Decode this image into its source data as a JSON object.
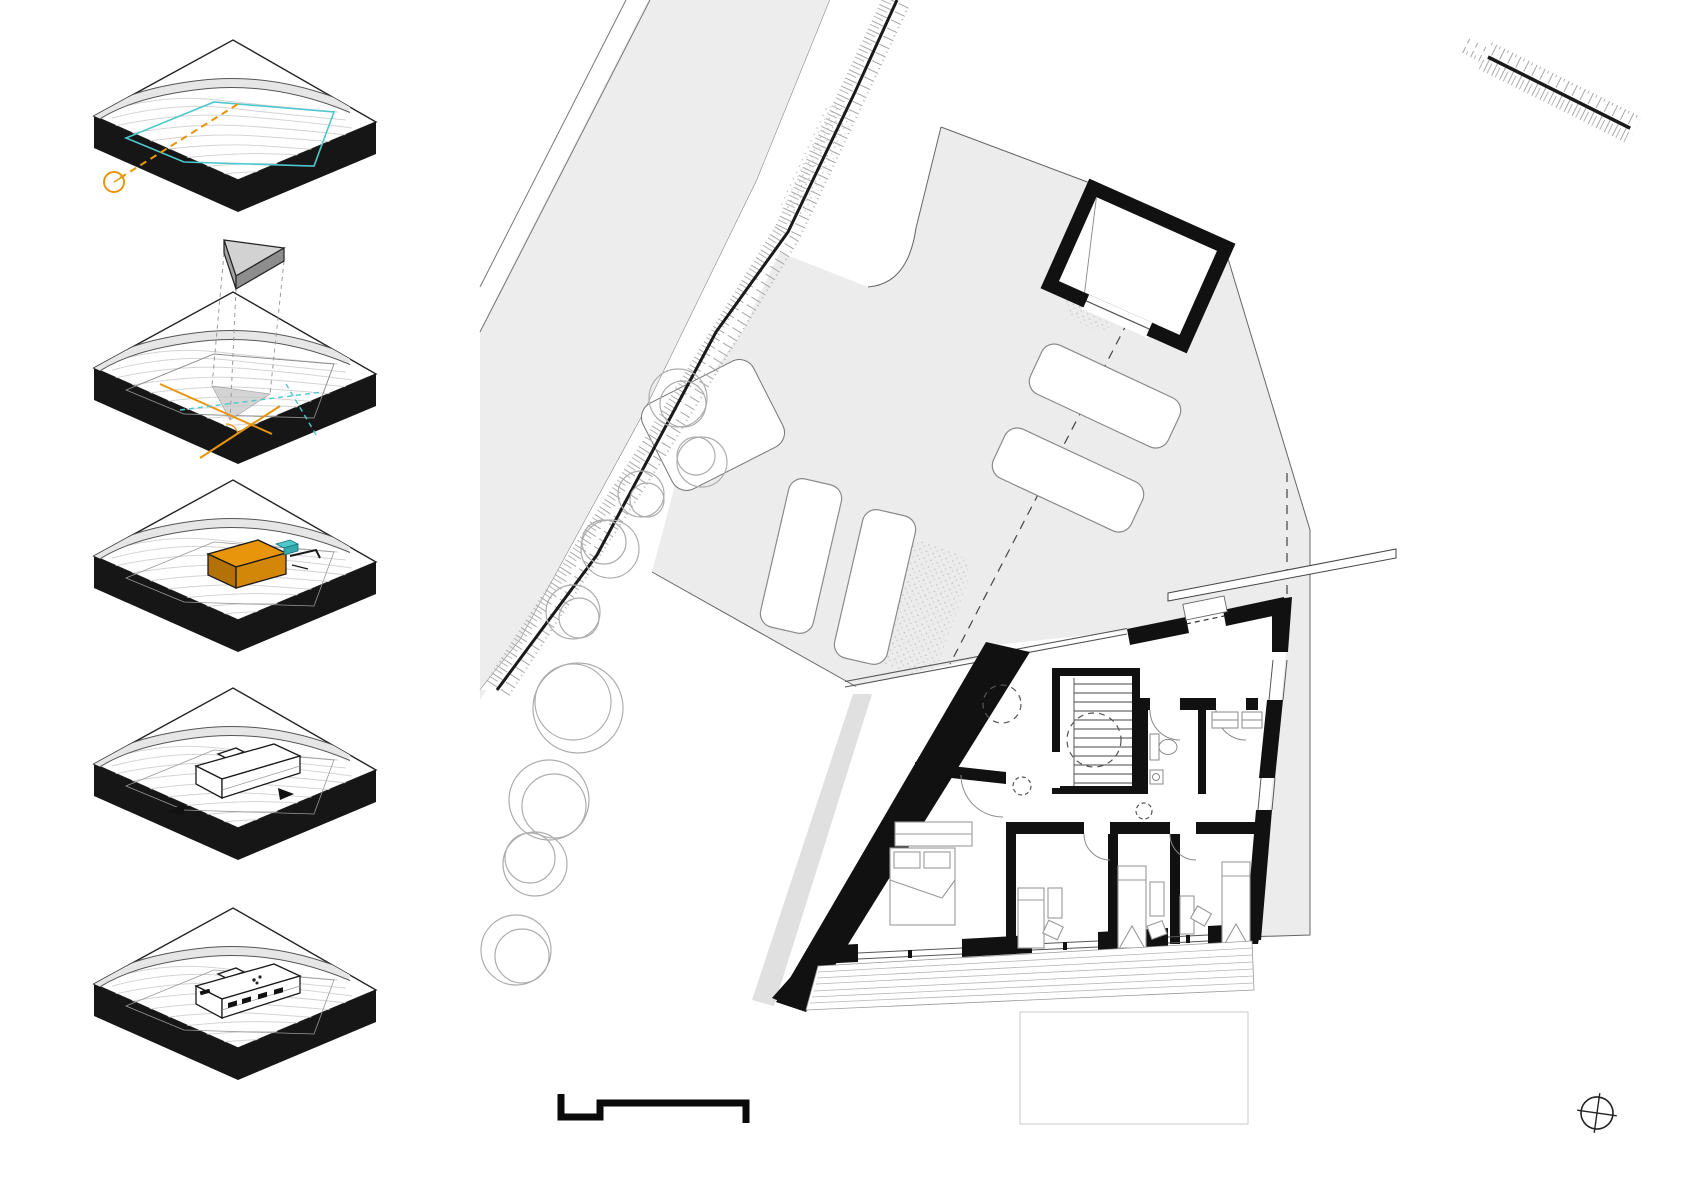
{
  "canvas": {
    "width_px": 1684,
    "height_px": 1191,
    "background": "#ffffff"
  },
  "colors": {
    "accent_orange": "#E8950B",
    "accent_orange_dark": "#B37208",
    "accent_orange_mid": "#D38708",
    "accent_cyan": "#4EC8CE",
    "ink": "#111111",
    "site_gray": "#ECECEC",
    "road_gray": "#EDEDED",
    "contour_gray": "#D4D4D4",
    "tree_gray": "#ADADAD",
    "boundary_gray": "#666666",
    "furniture_gray": "#999999"
  },
  "concept_diagrams": {
    "count": 5,
    "steps": [
      {
        "id": 1,
        "features": [
          "terrain-block",
          "contours",
          "road-band",
          "parcel-outline-cyan",
          "sun-axis-orange",
          "sun-circle"
        ]
      },
      {
        "id": 2,
        "features": [
          "terrain-block",
          "floating-wedge-volume",
          "projection-dashes",
          "ground-shadow-triangle",
          "orange-axes",
          "cyan-dashed-axes"
        ]
      },
      {
        "id": 3,
        "features": [
          "terrain-block",
          "placed-orange-volume",
          "cyan-entry-marker",
          "wall-stub"
        ]
      },
      {
        "id": 4,
        "features": [
          "terrain-block",
          "white-building-massing",
          "direction-arrows"
        ]
      },
      {
        "id": 5,
        "features": [
          "terrain-block",
          "white-building-detailed",
          "window-marks",
          "roof-dots"
        ]
      }
    ]
  },
  "site_plan": {
    "elements": [
      "street",
      "curb-lines",
      "embankment-hatch",
      "yard",
      "parcel-boundary",
      "dashed-property-lines",
      "parking-pad",
      "parking-spots",
      "garage-outbuilding",
      "gravel-stipple-patches",
      "trees",
      "house-floor-plan",
      "stair-core",
      "skylight-dashed-circles",
      "bathroom",
      "storage-room",
      "bedrooms",
      "south-deck",
      "lower-terrace-outline",
      "retaining-wall-bar"
    ],
    "parking_spots": 4,
    "trees": 9,
    "bedrooms": 4,
    "beds": 4,
    "skylight_circles": 4,
    "stair_treads": 12
  },
  "annotations": {
    "north_symbol": "circle-crosshair",
    "scale_bar": "stepped-graphic-scale",
    "embankment_marks": 2
  }
}
